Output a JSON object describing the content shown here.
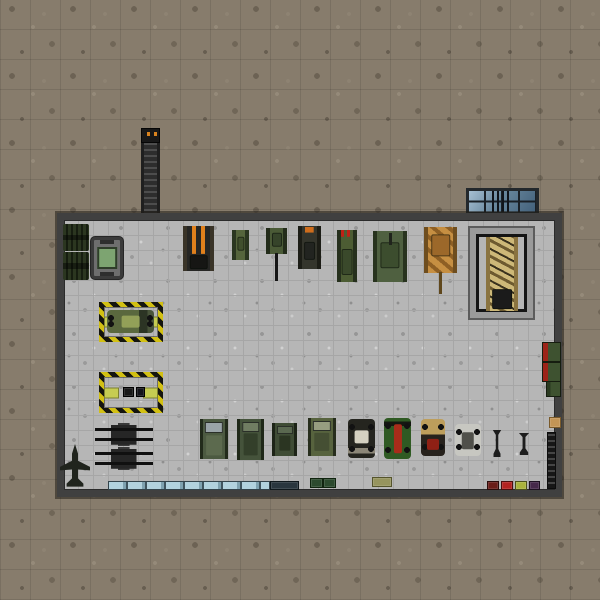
{
  "scene": {
    "description": "top-down military hangar map with vehicle collection",
    "terrain": "dirt",
    "palette": {
      "dirt": "#877c6c",
      "floor": "#b6b6b6",
      "wall": "#404040",
      "hazard_yellow": "#d2c013",
      "glass_blue": "#a6bfd2",
      "flame_orange": "#e0801c"
    }
  },
  "building": {
    "name": "hangar",
    "x": 57,
    "y": 213,
    "width": 505,
    "height": 284,
    "wall_thickness": 7
  },
  "sprites": [
    {
      "name": "chimney-ladder",
      "type": "chimney",
      "x": 141,
      "y": 128,
      "w": 19,
      "h": 87,
      "interactable": false
    },
    {
      "name": "skylight-window",
      "type": "skylight",
      "x": 466,
      "y": 188,
      "w": 73,
      "h": 27,
      "interactable": false
    },
    {
      "name": "aa-missile-rack-1",
      "type": "aa",
      "x": 63,
      "y": 224,
      "w": 26,
      "h": 27,
      "interactable": true
    },
    {
      "name": "aa-missile-rack-2",
      "type": "aa",
      "x": 63,
      "y": 252,
      "w": 26,
      "h": 28,
      "interactable": true
    },
    {
      "name": "green-screen-console",
      "type": "console",
      "x": 91,
      "y": 237,
      "w": 32,
      "h": 42,
      "interactable": true
    },
    {
      "name": "loading-bay-1",
      "type": "bay",
      "x": 99,
      "y": 302,
      "w": 64,
      "h": 40,
      "interactable": false
    },
    {
      "name": "bay-truck",
      "type": "car",
      "x": 107,
      "y": 310,
      "w": 47,
      "h": 23,
      "interactable": true,
      "vars": {
        "body": "#5a683e",
        "mid": "#93a058",
        "mw": "40%",
        "mh": "55%",
        "my": "50%",
        "deco": "linear-gradient(90deg,transparent 0 68%,#2c3424 68% 86%,#49543a 86%)"
      }
    },
    {
      "name": "loading-bay-2",
      "type": "bay",
      "x": 99,
      "y": 372,
      "w": 64,
      "h": 41,
      "interactable": false
    },
    {
      "name": "bay2-crate-1",
      "type": "crate",
      "x": 123,
      "y": 387,
      "w": 11,
      "h": 10,
      "interactable": true,
      "vars": {
        "body": "#191919",
        "edge": "#000000"
      }
    },
    {
      "name": "bay2-crate-2",
      "type": "crate",
      "x": 136,
      "y": 387,
      "w": 9,
      "h": 10,
      "interactable": true,
      "vars": {
        "body": "#14141a",
        "edge": "#000000"
      }
    },
    {
      "name": "flak-gun-1",
      "type": "flak",
      "x": 95,
      "y": 423,
      "w": 58,
      "h": 23,
      "interactable": true
    },
    {
      "name": "flak-gun-2",
      "type": "flak",
      "x": 95,
      "y": 447,
      "w": 58,
      "h": 23,
      "interactable": true
    },
    {
      "name": "fighter-jet",
      "type": "jet",
      "x": 60,
      "y": 444,
      "w": 30,
      "h": 44,
      "interactable": true
    },
    {
      "name": "burnt-flame-tank",
      "type": "tank",
      "x": 183,
      "y": 226,
      "w": 31,
      "h": 45,
      "interactable": true,
      "vars": {
        "track": "#3a3428",
        "body": "#262624",
        "turret": "#161614",
        "ty": "80%",
        "tw": "72%",
        "th": "26%",
        "deco": "linear-gradient(90deg,transparent 0 22%,#e0801c 22% 40%,transparent 40% 60%,#e0801c 60% 78%,transparent 78%)",
        "decosize": "100% 62%",
        "decopos": "top"
      }
    },
    {
      "name": "light-tank",
      "type": "tank",
      "x": 232,
      "y": 230,
      "w": 17,
      "h": 30,
      "interactable": true,
      "vars": {
        "body": "#55653c",
        "track": "#2a3620",
        "turret": "#404f2d",
        "ty": "46%",
        "tw": "58%",
        "th": "42%"
      }
    },
    {
      "name": "long-barrel-tank",
      "type": "tank",
      "x": 266,
      "y": 228,
      "w": 21,
      "h": 26,
      "interactable": true,
      "vars": {
        "body": "#4a5a36",
        "track": "#232c1a",
        "turret": "#36442a",
        "ty": "45%",
        "tw": "62%",
        "th": "48%",
        "bl": "28px",
        "by": "96%",
        "bc": "#161616"
      }
    },
    {
      "name": "orange-marked-tank",
      "type": "tank",
      "x": 298,
      "y": 226,
      "w": 23,
      "h": 43,
      "interactable": true,
      "vars": {
        "body": "#34352c",
        "track": "#1c1d16",
        "turret": "#222420",
        "ty": "58%",
        "tw": "66%",
        "th": "38%",
        "deco": "linear-gradient(90deg,#cf6d1c 0 100%)",
        "decosize": "58% 13%",
        "decopos": "50% 3%"
      }
    },
    {
      "name": "rocket-launcher-tank",
      "type": "tank",
      "x": 337,
      "y": 230,
      "w": 20,
      "h": 52,
      "interactable": true,
      "vars": {
        "body": "#4c5c33",
        "track": "#26301d",
        "turret": "#3a492b",
        "ty": "62%",
        "tw": "74%",
        "th": "46%",
        "deco": "repeating-linear-gradient(90deg,#c02016 0 3px,transparent 3px 6px)",
        "decosize": "100% 13%",
        "decopos": "top"
      }
    },
    {
      "name": "heavy-green-tank",
      "type": "tank",
      "x": 373,
      "y": 231,
      "w": 34,
      "h": 51,
      "interactable": true,
      "vars": {
        "body": "#4f6040",
        "track": "#28331e",
        "turret": "#3c4d2e",
        "ty": "48%",
        "tw": "66%",
        "th": "46%",
        "bl": "12px",
        "by": "4%",
        "bc": "#20241c"
      }
    },
    {
      "name": "desert-camo-tank",
      "type": "tank",
      "x": 424,
      "y": 227,
      "w": 33,
      "h": 46,
      "interactable": true,
      "vars": {
        "body": "#b07a33",
        "track": "#6e4d1e",
        "turret": "#9c682a",
        "ty": "40%",
        "tw": "70%",
        "th": "42%",
        "deco": "repeating-linear-gradient(40deg,#c68f42 0 6px,#8e5f24 6px 10px)",
        "bl": "22px",
        "by": "97%",
        "bc": "#5f471c"
      }
    },
    {
      "name": "display-frame",
      "type": "dframe",
      "x": 470,
      "y": 228,
      "w": 63,
      "h": 90,
      "interactable": false
    },
    {
      "name": "trophy-camo-tank",
      "type": "tank",
      "x": 486,
      "y": 237,
      "w": 32,
      "h": 74,
      "interactable": true,
      "vars": {
        "body": "#c4ab67",
        "track": "#8a7340",
        "turret": "#1b1b1b",
        "ty": "84%",
        "tw": "74%",
        "th": "24%",
        "deco": "repeating-linear-gradient(28deg,#cdb878 0 5px,#6d5a30 5px 8px,#cdb878 8px 12px,#39311d 12px 14px)"
      }
    },
    {
      "name": "wall-turret-1",
      "type": "ti",
      "x": 542,
      "y": 342,
      "w": 19,
      "h": 20,
      "interactable": true
    },
    {
      "name": "wall-turret-2",
      "type": "ti",
      "x": 542,
      "y": 362,
      "w": 19,
      "h": 20,
      "interactable": true
    },
    {
      "name": "wall-turret-3",
      "type": "ti",
      "x": 546,
      "y": 381,
      "w": 15,
      "h": 16,
      "interactable": true,
      "vars": {
        "acc": "#2a3a20"
      }
    },
    {
      "name": "tan-crate",
      "type": "crate",
      "x": 549,
      "y": 417,
      "w": 12,
      "h": 11,
      "interactable": true,
      "vars": {
        "body": "#c39556",
        "edge": "#7a5a2a"
      }
    },
    {
      "name": "weapon-rack-strip",
      "type": "rackstrip",
      "x": 547,
      "y": 432,
      "w": 9,
      "h": 57,
      "interactable": true
    },
    {
      "name": "apc-truck-1",
      "type": "truck",
      "x": 200,
      "y": 419,
      "w": 28,
      "h": 40,
      "interactable": true,
      "vars": {
        "body": "#4c5a41",
        "track": "#222b1b",
        "glass": "#9aa4a8",
        "gy": "8%",
        "gh": "22%",
        "mid": "#5c6a4e",
        "my": "66%",
        "mw": "72%",
        "mh": "48%"
      }
    },
    {
      "name": "apc-truck-2",
      "type": "truck",
      "x": 237,
      "y": 419,
      "w": 27,
      "h": 41,
      "interactable": true,
      "vars": {
        "body": "#45533b",
        "track": "#1f2818",
        "glass": "#707d62",
        "gy": "8%",
        "gh": "20%",
        "mid": "#333f2a",
        "my": "62%",
        "mw": "70%",
        "mh": "52%"
      }
    },
    {
      "name": "tractor",
      "type": "truck",
      "x": 272,
      "y": 423,
      "w": 25,
      "h": 33,
      "interactable": true,
      "vars": {
        "body": "#3f4c35",
        "track": "#1d2417",
        "glass": "#5a6850",
        "gy": "10%",
        "gh": "18%",
        "mid": "#2b3522",
        "my": "60%",
        "mw": "60%",
        "mh": "45%"
      }
    },
    {
      "name": "military-jeep",
      "type": "truck",
      "x": 308,
      "y": 418,
      "w": 28,
      "h": 38,
      "interactable": true,
      "vars": {
        "body": "#57633e",
        "track": "#272e1d",
        "glass": "#979e80",
        "gy": "9%",
        "gh": "20%",
        "mid": "#454f33",
        "my": "62%",
        "mw": "70%",
        "mh": "48%"
      }
    },
    {
      "name": "vintage-car",
      "type": "car",
      "x": 348,
      "y": 419,
      "w": 27,
      "h": 39,
      "interactable": true,
      "vars": {
        "body": "#25251f",
        "mid": "#d5d1c1",
        "mw": "55%",
        "mh": "34%",
        "my": "46%",
        "deco": "linear-gradient(transparent 0 75%,#8c8778 75% 88%,transparent 88%)"
      }
    },
    {
      "name": "green-hotrod",
      "type": "car",
      "x": 384,
      "y": 418,
      "w": 27,
      "h": 41,
      "interactable": true,
      "vars": {
        "body": "#2f5a23",
        "mid": "#a82c1a",
        "mw": "30%",
        "mh": "72%",
        "my": "50%",
        "deco": "linear-gradient(transparent 0 8%,#151811 8% 20%,transparent 20%)"
      }
    },
    {
      "name": "tan-red-car",
      "type": "car",
      "x": 421,
      "y": 419,
      "w": 24,
      "h": 37,
      "interactable": true,
      "vars": {
        "body": "#27221d",
        "mid": "#8f2015",
        "mw": "50%",
        "mh": "28%",
        "my": "68%",
        "deco": "linear-gradient(#bd9e5c 0 42%,transparent 42%)"
      }
    },
    {
      "name": "white-buggy",
      "type": "car",
      "x": 455,
      "y": 424,
      "w": 26,
      "h": 32,
      "interactable": true,
      "vars": {
        "body": "#c7c7c1",
        "mid": "#50504a",
        "mw": "48%",
        "mh": "55%",
        "my": "52%"
      }
    },
    {
      "name": "bomb-1",
      "type": "bomb",
      "x": 492,
      "y": 430,
      "w": 10,
      "h": 27,
      "interactable": true
    },
    {
      "name": "bomb-2",
      "type": "bomb",
      "x": 518,
      "y": 433,
      "w": 12,
      "h": 22,
      "interactable": true
    },
    {
      "name": "blue-barrier-row",
      "type": "barrier",
      "x": 108,
      "y": 481,
      "w": 162,
      "h": 9,
      "interactable": true
    },
    {
      "name": "dark-barrier-segment",
      "type": "crate",
      "x": 270,
      "y": 481,
      "w": 29,
      "h": 9,
      "interactable": true,
      "vars": {
        "body": "#2a363e",
        "edge": "#10181c"
      }
    },
    {
      "name": "green-crate-1",
      "type": "crate",
      "x": 310,
      "y": 478,
      "w": 13,
      "h": 10,
      "interactable": true,
      "vars": {
        "body": "#2c4a2e",
        "edge": "#10240f"
      }
    },
    {
      "name": "green-crate-2",
      "type": "crate",
      "x": 323,
      "y": 478,
      "w": 13,
      "h": 10,
      "interactable": true,
      "vars": {
        "body": "#2c4a2e",
        "edge": "#10240f"
      }
    },
    {
      "name": "olive-crate",
      "type": "crate",
      "x": 372,
      "y": 477,
      "w": 20,
      "h": 10,
      "interactable": true,
      "vars": {
        "body": "#96945e",
        "edge": "#55542c"
      }
    },
    {
      "name": "dark-red-crate",
      "type": "crate",
      "x": 487,
      "y": 481,
      "w": 12,
      "h": 9,
      "interactable": true,
      "vars": {
        "body": "#6a1d18",
        "edge": "#2a0c0a"
      }
    },
    {
      "name": "red-crate",
      "type": "crate",
      "x": 501,
      "y": 481,
      "w": 12,
      "h": 9,
      "interactable": true,
      "vars": {
        "body": "#b42320",
        "edge": "#4a0e0c"
      }
    },
    {
      "name": "yellow-crate",
      "type": "crate",
      "x": 515,
      "y": 481,
      "w": 12,
      "h": 9,
      "interactable": true,
      "vars": {
        "body": "#aab33c",
        "edge": "#4c511a"
      }
    },
    {
      "name": "purple-crate",
      "type": "crate",
      "x": 529,
      "y": 481,
      "w": 11,
      "h": 9,
      "interactable": true,
      "vars": {
        "body": "#45284a",
        "edge": "#1c1020"
      }
    }
  ]
}
